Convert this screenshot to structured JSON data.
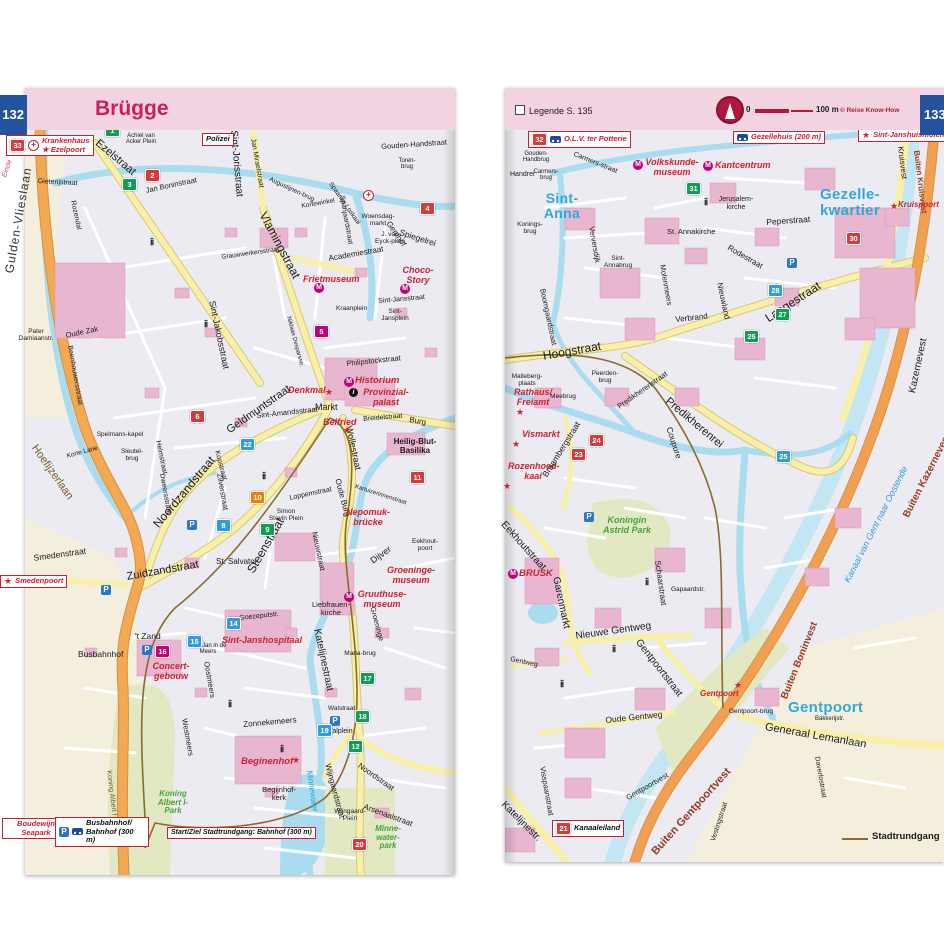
{
  "hdr": {
    "tab_left": "132",
    "title": "Brügge",
    "legend": "Legende S. 135",
    "scale0": "0",
    "scale100": "100 m",
    "copyright": "© Reise Know-How",
    "tab_right": "133",
    "rundgang_legend": "Stadtrundgang"
  },
  "L": {
    "einde": "Einde",
    "gulden": "Gulden-Vlieslaan",
    "hoefijzer": "Hoefijzerlaan",
    "ezelstraat": "Ezelstraat",
    "joris": "Sint-Jorisstraat",
    "bonin": "Jan Boninstraat",
    "gieterij": "Gieterijstraat",
    "rozendal": "Rozendal",
    "achiel": "Achiel van Acker Plein",
    "schrijvers": "Schrijversstr.",
    "mirael": "Jan Miraelstraat",
    "goudenhand": "Gouden-Handstraat",
    "toren": "Toren-brug",
    "augustijnen": "Augustijnen-brug",
    "spaanse": "Spaanse Loskaai",
    "polizei": "Polizei",
    "kortewinkel": "Kortewinkel",
    "vlaming": "Vlamingstraat",
    "spanjaard": "Spanjaardstraat",
    "woensdag": "Woensdag-markt",
    "eyck": "J. van Eyck-plein",
    "genthof": "Genthof",
    "spiegel": "Spiegelrei",
    "academie": "Academiestraat",
    "grauwwerkers": "Grauwwerkersstraat",
    "jakobs": "Sint-Jakobsstraat",
    "friet": "Frietmuseum",
    "choco": "Choco-Story",
    "kraan": "Kraanplein",
    "jansstraat": "Sint-Jansstraat",
    "jansplein": "Sint-Jansplein",
    "despars": "Niklaas Desparsstr.",
    "philipstock": "Philipstockstraat",
    "historium": "Historium",
    "denkmal": "Denkmal",
    "provinzial": "Provinzial-palast",
    "markt": "Markt",
    "belfried": "Belfried",
    "breidel": "Breidelstraat",
    "burg": "Burg",
    "wolle": "Wollestraat",
    "heiligblut": "Heilig-Blut-Basilika",
    "geldmunt": "Geldmuntstraat",
    "amands": "Sint-Amandsstraat",
    "noordzand": "Noordzandstraat",
    "steen": "Steenstraat",
    "zilver": "Zilverstraat",
    "kop": "Kopstraat",
    "helm": "Helmstraat",
    "dweers": "Dweersstraat",
    "stevin": "Simon Stevin Plein",
    "loppem": "Loppemstraat",
    "oudeburg": "Oude Burg",
    "kartuizer": "Kartuizerinnenstraat",
    "nieuwstraat": "Nieuwstraat",
    "dijver": "Dijver",
    "salvator": "St. Salvator",
    "groeningestr": "Groeninge",
    "eekhoutpoort": "Eekhout-poort",
    "groeningemus": "Groeninge-museum",
    "gruuthusemus": "Gruuthuse-museum",
    "nepomuk": "Nepomuk-brücke",
    "liebfrauen": "Liebfrauen-kirche",
    "janshospitaal": "Sint-Janshospitaal",
    "goezeput": "Goezeputstr.",
    "katelijne": "Katelijnestraat",
    "mariabrug": "Maria-brug",
    "walstraat": "Walstraat",
    "walplein": "Walplein",
    "zonneke": "Zonnekemeers",
    "oostmeers": "Oostmeers",
    "westmeers": "Westmeers",
    "smedenstraat": "Smedenstraat",
    "smedenpoort": "Smedenpoort",
    "zuidzand": "Zuidzandstraat",
    "tzand": "'t Zand",
    "kortelane": "Korte Lane",
    "spelmans": "Spelmans-kapel",
    "sleutel": "Sleutel-brug",
    "oudezak": "Oude Zak",
    "pater": "Pater Damiaanstr.",
    "beenhouwers": "Beenhouwersstraat",
    "busbahnhof": "Busbahnhof",
    "concertgebouw": "Concert-gebouw",
    "janmeers": "Sint-Jan in de Meers",
    "albertlaan": "Koning Albert I Laan",
    "albertpark": "Koning Albert I-Park",
    "seapark": "Boudewijn Seapark",
    "bahnhofbox": "Busbahnhof/ Bahnhof (300 m)",
    "rundgangbox": "Start/Ziel Stadtrundgang: Bahnhof (300 m)",
    "beginenhof": "Beginenhof",
    "begijnhofkerk": "Begijnhof-kerk",
    "wijngaardstraat": "Wijngaardstraat",
    "wijngaardplein": "Wijngaard-Plein",
    "noordstraat": "Noordstraat",
    "arsenaal": "Arsenaalstraat",
    "minnewater": "Minnewater",
    "minnewaterpark": "Minne-water-park",
    "krankenhaus": "Krankenhaus",
    "ezelpoort": "Ezelpoort"
  },
  "R": {
    "olv": "O.L.V. ter Potterie",
    "gezellehuis": "Gezellehuis (200 m)",
    "janshuismolen": "Sint-Janshuismolen",
    "volkskunde": "Volkskunde-museum",
    "kantcentrum": "Kantcentrum",
    "goudenhandbrug": "Gouden-Handbrug",
    "handrei": "Handrei",
    "carmersbrug": "Carmers-brug",
    "carmersstraat": "Carmers-straat",
    "jerusalem": "Jerusalem-kirche",
    "annakirche": "St. Annakirche",
    "sintanna": "Sint-Anna",
    "gezellekwartier": "Gezelle-kwartier",
    "kruisvest": "Kruisvest",
    "buitenkruis": "Buiten Kruisvest",
    "kruispoort": "Kruispoort",
    "koningsbrug": "Konings-brug",
    "annabrug": "Sint-Annabrug",
    "ververs": "Verversdijk",
    "molenmeers": "Molenmeers",
    "boomgaard": "Boomgaardstraat",
    "peper": "Peperstraat",
    "rodestraat": "Rodestraat",
    "nieuwland": "Nieuwland",
    "verbrand": "Verbrand",
    "langestraat": "Langestraat",
    "hoogstraat": "Hoogstraat",
    "predikrei": "Predikherenrei",
    "predikstr": "Predikherenstraat",
    "kazernevest": "Kazernevest",
    "buitenkazerne": "Buiten Kazernevest",
    "kanaal": "Kanaal van Gent naar Oostende",
    "malleberg": "Malleberg-plaats",
    "rathaus": "Rathaus/ Freiamt",
    "peerden": "Peerden-brug",
    "meebrug": "Meebrug",
    "vismarkt": "Vismarkt",
    "rozenhoed": "Rozenhoed-kaai",
    "braamberg": "Braambergstraat",
    "coupure": "Coupure",
    "astridpark": "Koningin Astrid Park",
    "brusk": "BRUSK",
    "eekhoutstraat": "Eekhoutstraat",
    "garenmarkt": "Garenmarkt",
    "nieuwegentweg": "Nieuwe Gentweg",
    "gentpoortstraat": "Gentpoortstraat",
    "schaarstraat": "Schaarstraat",
    "gapaard": "Gapaardstr.",
    "gentweg": "Gentweg",
    "oudegentweg": "Oude Gentweg",
    "gentpoort_poi": "Gentpoort",
    "gentpoortbrug": "Gentpoort-brug",
    "gentpoort_big": "Gentpoort",
    "bakkerij": "Bakkerijstr.",
    "lemanlaan": "Generaal Lemanlaan",
    "buitenbonin": "Buiten Boninvest",
    "buitengent": "Buiten Gentpoortvest",
    "gentpoortvest": "Gentpoortvest",
    "vesting": "Vestingstraat",
    "daverlo": "Daverlostraat",
    "katelijnestr": "Katelijnestr.",
    "visspaan": "Visspaanstraat",
    "kanaaleiland": "Kanaaleiland"
  },
  "Lm": [
    "33",
    "1",
    "2",
    "3",
    "4",
    "5",
    "6",
    "22",
    "10",
    "8",
    "9",
    "11",
    "14",
    "15",
    "16",
    "17",
    "18",
    "19",
    "12",
    "20"
  ],
  "Rm": [
    "32",
    "31",
    "30",
    "28",
    "27",
    "26",
    "25",
    "24",
    "23",
    "21"
  ]
}
